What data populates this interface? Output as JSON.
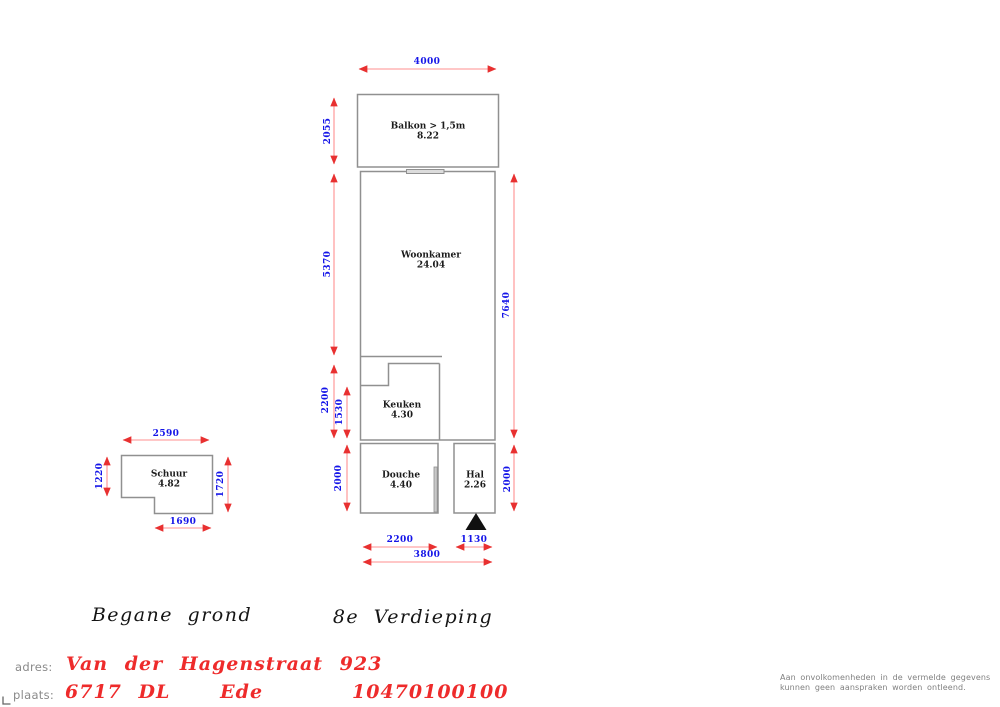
{
  "colors": {
    "dimension_text": "#1515e8",
    "dimension_line": "#ff8f8f",
    "dimension_arrow": "#e83030",
    "wall_gray": "#909090",
    "accent_red": "#ee2b2b",
    "muted_gray": "#8a8a8a",
    "entrance_marker": "#101010"
  },
  "floor8": {
    "title": "8e  Verdieping",
    "rooms": [
      {
        "id": "balkon",
        "name": "Balkon > 1,5m",
        "area": "8.22"
      },
      {
        "id": "woonkamer",
        "name": "Woonkamer",
        "area": "24.04"
      },
      {
        "id": "keuken",
        "name": "Keuken",
        "area": "4.30"
      },
      {
        "id": "douche",
        "name": "Douche",
        "area": "4.40"
      },
      {
        "id": "hal",
        "name": "Hal",
        "area": "2.26"
      }
    ],
    "dimensions": {
      "top_width": "4000",
      "balkon_height": "2055",
      "woonkamer_height": "5370",
      "right_total_height": "7640",
      "keuken_height": "2200",
      "keuken_inner_height": "1530",
      "douche_height": "2000",
      "hal_height": "2000",
      "douche_width": "2200",
      "hal_width": "1130",
      "bottom_total_width": "3800"
    }
  },
  "ground_floor": {
    "title": "Begane  grond",
    "rooms": [
      {
        "id": "schuur",
        "name": "Schuur",
        "area": "4.82"
      }
    ],
    "dimensions": {
      "top_width": "2590",
      "left_height": "1220",
      "right_height": "1720",
      "bottom_width": "1690"
    }
  },
  "footer": {
    "adres_label": "adres:",
    "adres_value": "Van der Hagenstraat 923",
    "plaats_label": "plaats:",
    "plaats_value": "6717 DL   Ede",
    "reference": "10470100100",
    "disclaimer_line1": "Aan onvolkomenheden in de vermelde gegevens",
    "disclaimer_line2": "kunnen geen aanspraken worden ontleend."
  }
}
